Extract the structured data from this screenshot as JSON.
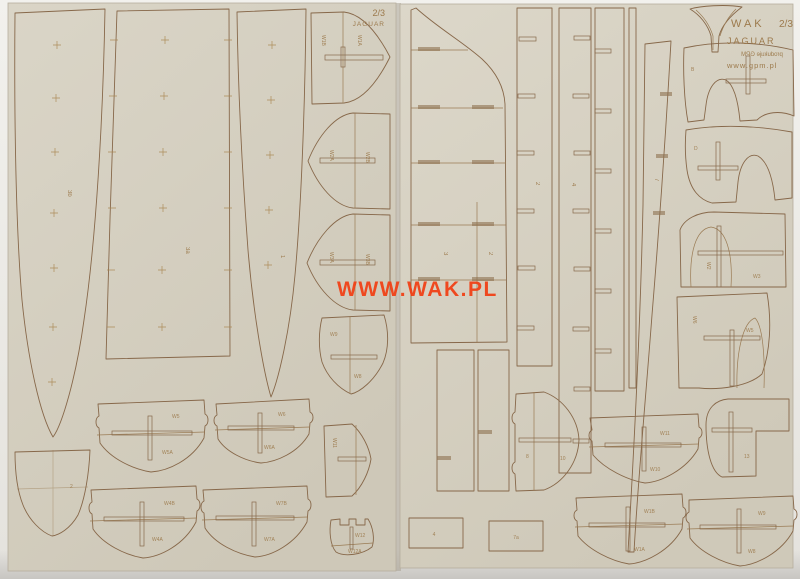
{
  "photo": {
    "watermark": "WWW.WAK.PL",
    "watermark_color": "#f23d12"
  },
  "left_sheet": {
    "corner_scale": "2/3",
    "corner_model": "JAGUAR",
    "parts": {
      "blade": "3b",
      "panel": "3a",
      "dagger": "1",
      "shield1_left": "W1B",
      "shield1_right": "W1A",
      "shield2_left": "W2A",
      "shield2_right": "W2B",
      "shield3_left": "W3A",
      "shield3_right": "W3B",
      "small_shield_top": "W9",
      "small_shield_bottom": "W8",
      "frame1_top": "W5",
      "frame1_bottom": "W5A",
      "frame2_top": "W6",
      "frame2_bottom": "W6A",
      "rotated_frame": "W11",
      "notched_top": "W12",
      "notched_bottom": "W12A",
      "bowl": "2",
      "bframe1_top": "W4B",
      "bframe1_bottom": "W4A",
      "bframe2_top": "W7B",
      "bframe2_bottom": "W7A"
    }
  },
  "right_sheet": {
    "brand": "WAK",
    "scale": "2/3",
    "model": "JAGUAR",
    "producer": "produkuje GPM",
    "website": "www.gpm.pl",
    "parts": {
      "keel_seg_a": "3",
      "keel_seg_b": "2",
      "stringer1": "2",
      "stringer2": "4",
      "tapered_strip": "7",
      "swoosh1": "B",
      "swoosh2": "D",
      "arch1_left": "W2",
      "arch1_right": "W3",
      "arch2_left": "W6",
      "arch2_right": "W5",
      "bracket": "13",
      "dframe_left": "8",
      "dframe_right": "10",
      "rect1": "4",
      "rect2": "7a",
      "midframe_top": "W11",
      "midframe_bottom": "W10",
      "bframe1_top": "W1B",
      "bframe1_bottom": "W1A",
      "bframe2_top": "W9",
      "bframe2_bottom": "W8"
    }
  }
}
